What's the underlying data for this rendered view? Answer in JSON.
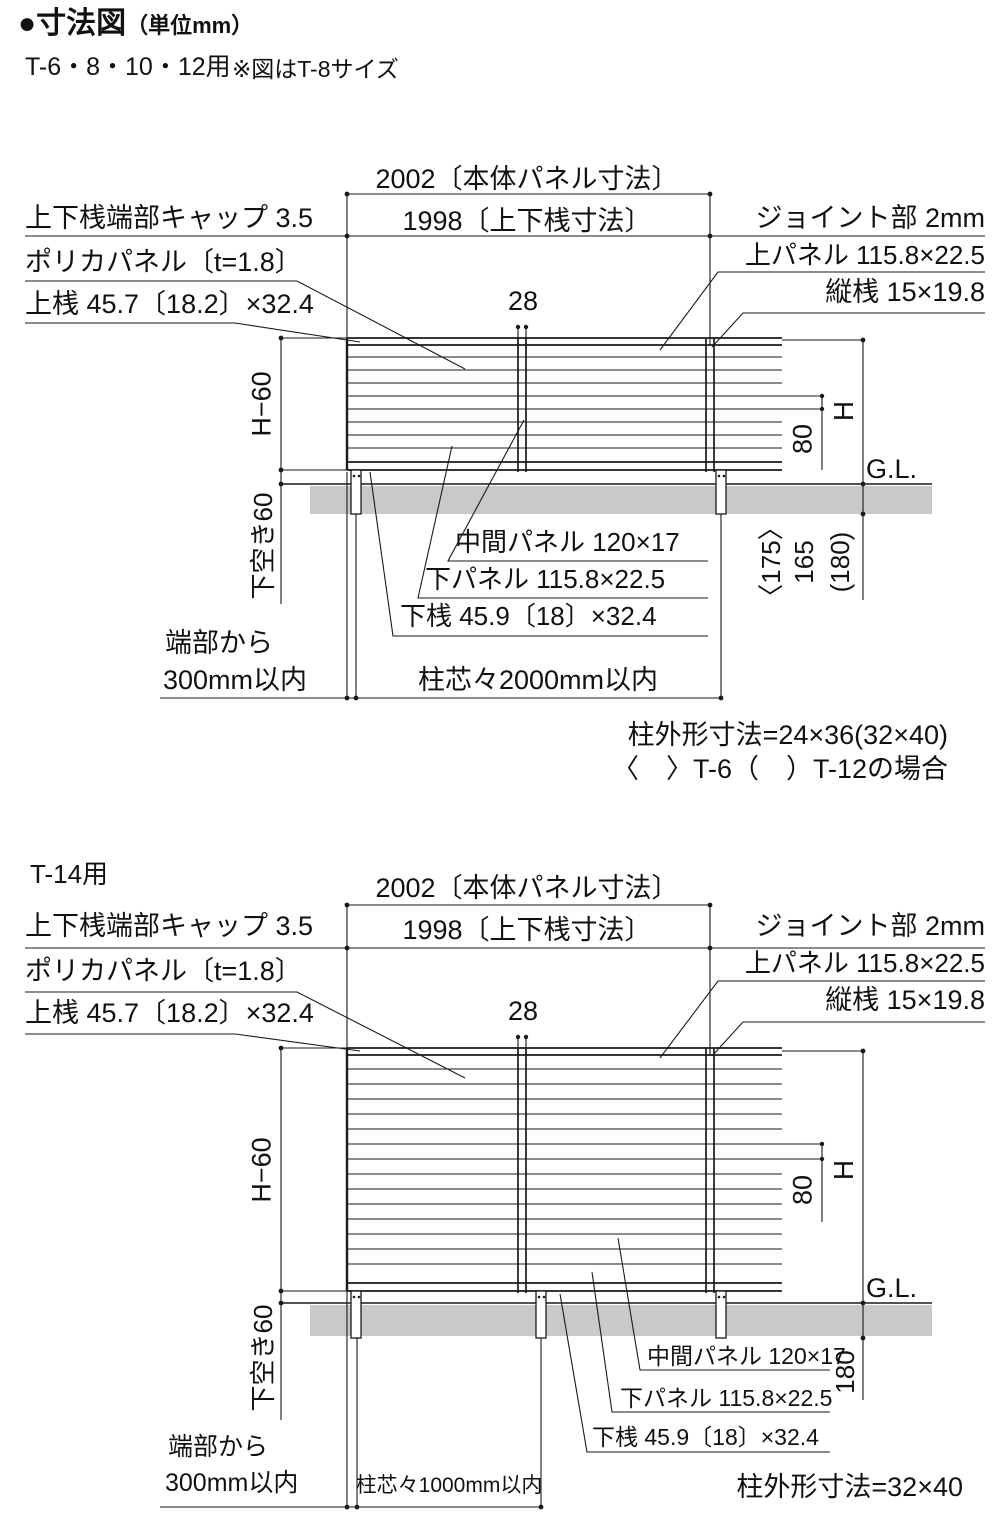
{
  "header": {
    "title": "●寸法図",
    "unit": "（単位mm）",
    "subtitle": "T-6・8・10・12用",
    "note": "※図はT-8サイズ"
  },
  "colors": {
    "line": "#1a1a1a",
    "ground": "#c9c9c9"
  },
  "diagram1": {
    "dim_body_panel": "2002〔本体パネル寸法〕",
    "dim_rail": "1998〔上下桟寸法〕",
    "label_cap": "上下桟端部キャップ 3.5",
    "label_poly_panel": "ポリカパネル〔t=1.8〕",
    "label_top_rail": "上桟 45.7〔18.2〕×32.4",
    "label_joint": "ジョイント部 2mm",
    "label_top_panel": "上パネル 115.8×22.5",
    "label_vertical_rail": "縦桟 15×19.8",
    "dim_28": "28",
    "dim_h60": "H−60",
    "dim_h": "H",
    "dim_80": "80",
    "label_gl": "G.L.",
    "dim_depth_t6": "〈175〉",
    "dim_depth": "165",
    "dim_depth_t12": "(180)",
    "label_mid_panel": "中間パネル 120×17",
    "label_bottom_panel": "下パネル 115.8×22.5",
    "label_bottom_rail": "下桟 45.9〔18〕×32.4",
    "dim_bottom_gap": "下空き60",
    "label_edge_1": "端部から",
    "label_edge_2": "300mm以内",
    "dim_post_pitch": "柱芯々2000mm以内",
    "note_post_size": "柱外形寸法=24×36(32×40)",
    "note_post_size_2": "〈　〉T-6（　）T-12の場合"
  },
  "diagram2": {
    "title": "T-14用",
    "dim_body_panel": "2002〔本体パネル寸法〕",
    "dim_rail": "1998〔上下桟寸法〕",
    "label_cap": "上下桟端部キャップ 3.5",
    "label_poly_panel": "ポリカパネル〔t=1.8〕",
    "label_top_rail": "上桟 45.7〔18.2〕×32.4",
    "label_joint": "ジョイント部 2mm",
    "label_top_panel": "上パネル 115.8×22.5",
    "label_vertical_rail": "縦桟 15×19.8",
    "dim_28": "28",
    "dim_h60": "H−60",
    "dim_h": "H",
    "dim_80": "80",
    "label_gl": "G.L.",
    "dim_depth": "180",
    "label_mid_panel": "中間パネル 120×17",
    "label_bottom_panel": "下パネル 115.8×22.5",
    "label_bottom_rail": "下桟 45.9〔18〕×32.4",
    "dim_bottom_gap": "下空き60",
    "label_edge_1": "端部から",
    "label_edge_2": "300mm以内",
    "dim_post_pitch": "柱芯々1000mm以内",
    "note_post_size": "柱外形寸法=32×40"
  }
}
